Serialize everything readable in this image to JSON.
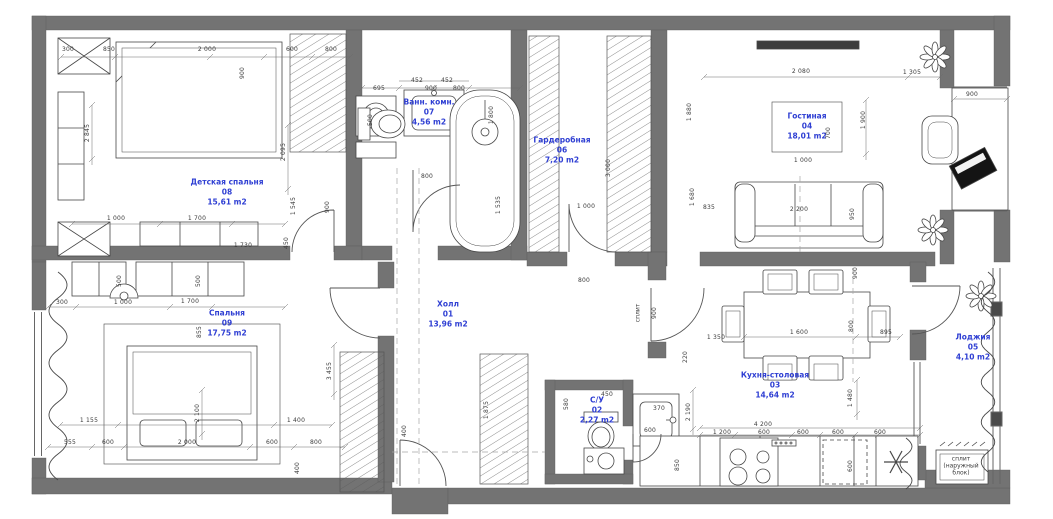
{
  "colors": {
    "wall": "#737373",
    "room_label_blue": "#2f3fd3",
    "dim_text": "#3c3c3c",
    "furniture_line": "#474747",
    "background": "#ffffff"
  },
  "rooms": [
    {
      "name": "Детская спальня",
      "number": "08",
      "area": "15,61 m2",
      "x": 227,
      "y": 192
    },
    {
      "name": "Ванн. комн.",
      "number": "07",
      "area": "4,56 m2",
      "x": 429,
      "y": 112
    },
    {
      "name": "Гардеробная",
      "number": "06",
      "area": "7,20 m2",
      "x": 562,
      "y": 150
    },
    {
      "name": "Гостиная",
      "number": "04",
      "area": "18,01 m2",
      "x": 807,
      "y": 126
    },
    {
      "name": "Спальня",
      "number": "09",
      "area": "17,75 m2",
      "x": 227,
      "y": 323
    },
    {
      "name": "Холл",
      "number": "01",
      "area": "13,96 m2",
      "x": 448,
      "y": 314
    },
    {
      "name": "С/У",
      "number": "02",
      "area": "2,27 m2",
      "x": 597,
      "y": 410
    },
    {
      "name": "Кухня-столовая",
      "number": "03",
      "area": "14,64 m2",
      "x": 775,
      "y": 385
    },
    {
      "name": "Лоджия",
      "number": "05",
      "area": "4,10 m2",
      "x": 973,
      "y": 347
    }
  ],
  "annotations": [
    {
      "text": "сплит",
      "x": 639,
      "y": 313,
      "rot": true,
      "lines": [
        "сплит"
      ]
    },
    {
      "text": "сплит (наружный блок)",
      "x": 961,
      "y": 467,
      "rot": false,
      "lines": [
        "сплит",
        "(наружный",
        "блок)"
      ]
    }
  ],
  "dimensions": [
    {
      "t": "300",
      "x": 68,
      "y": 50
    },
    {
      "t": "850",
      "x": 109,
      "y": 50
    },
    {
      "t": "2 000",
      "x": 207,
      "y": 50
    },
    {
      "t": "600",
      "x": 292,
      "y": 50
    },
    {
      "t": "800",
      "x": 331,
      "y": 50
    },
    {
      "t": "900",
      "x": 243,
      "y": 73,
      "r": 1
    },
    {
      "t": "2 845",
      "x": 88,
      "y": 133,
      "r": 1
    },
    {
      "t": "2 095",
      "x": 284,
      "y": 152,
      "r": 1
    },
    {
      "t": "1 545",
      "x": 294,
      "y": 206,
      "r": 1
    },
    {
      "t": "900",
      "x": 328,
      "y": 207,
      "r": 1
    },
    {
      "t": "450",
      "x": 287,
      "y": 243,
      "r": 1
    },
    {
      "t": "1 000",
      "x": 116,
      "y": 219
    },
    {
      "t": "1 700",
      "x": 197,
      "y": 219
    },
    {
      "t": "1 730",
      "x": 243,
      "y": 246
    },
    {
      "t": "695",
      "x": 379,
      "y": 89
    },
    {
      "t": "452",
      "x": 417,
      "y": 81
    },
    {
      "t": "452",
      "x": 447,
      "y": 81
    },
    {
      "t": "900",
      "x": 431,
      "y": 89
    },
    {
      "t": "800",
      "x": 459,
      "y": 89
    },
    {
      "t": "500",
      "x": 371,
      "y": 120,
      "r": 1
    },
    {
      "t": "1 800",
      "x": 492,
      "y": 115,
      "r": 1
    },
    {
      "t": "800",
      "x": 427,
      "y": 177
    },
    {
      "t": "1 535",
      "x": 499,
      "y": 205,
      "r": 1
    },
    {
      "t": "3 000",
      "x": 609,
      "y": 168,
      "r": 1
    },
    {
      "t": "1 000",
      "x": 586,
      "y": 207
    },
    {
      "t": "800",
      "x": 584,
      "y": 281
    },
    {
      "t": "2 080",
      "x": 801,
      "y": 72
    },
    {
      "t": "1 305",
      "x": 912,
      "y": 73
    },
    {
      "t": "900",
      "x": 972,
      "y": 95
    },
    {
      "t": "1 900",
      "x": 864,
      "y": 120,
      "r": 1
    },
    {
      "t": "700",
      "x": 829,
      "y": 133,
      "r": 1
    },
    {
      "t": "1 000",
      "x": 803,
      "y": 161
    },
    {
      "t": "1 880",
      "x": 690,
      "y": 112,
      "r": 1
    },
    {
      "t": "1 680",
      "x": 693,
      "y": 197,
      "r": 1
    },
    {
      "t": "835",
      "x": 709,
      "y": 208
    },
    {
      "t": "2 200",
      "x": 799,
      "y": 210
    },
    {
      "t": "950",
      "x": 853,
      "y": 214,
      "r": 1
    },
    {
      "t": "900",
      "x": 655,
      "y": 313,
      "r": 1
    },
    {
      "t": "220",
      "x": 686,
      "y": 357,
      "r": 1
    },
    {
      "t": "900",
      "x": 856,
      "y": 273,
      "r": 1
    },
    {
      "t": "1 600",
      "x": 799,
      "y": 333
    },
    {
      "t": "800",
      "x": 852,
      "y": 326,
      "r": 1
    },
    {
      "t": "895",
      "x": 886,
      "y": 333
    },
    {
      "t": "1 350",
      "x": 716,
      "y": 338
    },
    {
      "t": "1 480",
      "x": 851,
      "y": 398,
      "r": 1
    },
    {
      "t": "2 190",
      "x": 689,
      "y": 412,
      "r": 1
    },
    {
      "t": "450",
      "x": 607,
      "y": 395
    },
    {
      "t": "370",
      "x": 659,
      "y": 409
    },
    {
      "t": "580",
      "x": 567,
      "y": 404,
      "r": 1
    },
    {
      "t": "4 200",
      "x": 763,
      "y": 425
    },
    {
      "t": "1 200",
      "x": 722,
      "y": 433
    },
    {
      "t": "600",
      "x": 764,
      "y": 433
    },
    {
      "t": "600",
      "x": 803,
      "y": 433
    },
    {
      "t": "600",
      "x": 838,
      "y": 433
    },
    {
      "t": "600",
      "x": 880,
      "y": 433
    },
    {
      "t": "850",
      "x": 678,
      "y": 465,
      "r": 1
    },
    {
      "t": "600",
      "x": 851,
      "y": 466,
      "r": 1
    },
    {
      "t": "600",
      "x": 650,
      "y": 431
    },
    {
      "t": "1 875",
      "x": 487,
      "y": 410,
      "r": 1
    },
    {
      "t": "400",
      "x": 405,
      "y": 431,
      "r": 1
    },
    {
      "t": "500",
      "x": 120,
      "y": 281,
      "r": 1
    },
    {
      "t": "500",
      "x": 199,
      "y": 281,
      "r": 1
    },
    {
      "t": "300",
      "x": 62,
      "y": 303
    },
    {
      "t": "1 000",
      "x": 123,
      "y": 303
    },
    {
      "t": "1 700",
      "x": 190,
      "y": 302
    },
    {
      "t": "855",
      "x": 200,
      "y": 332,
      "r": 1
    },
    {
      "t": "2 100",
      "x": 198,
      "y": 413,
      "r": 1
    },
    {
      "t": "1 155",
      "x": 89,
      "y": 421
    },
    {
      "t": "1 400",
      "x": 296,
      "y": 421
    },
    {
      "t": "555",
      "x": 70,
      "y": 443
    },
    {
      "t": "600",
      "x": 108,
      "y": 443
    },
    {
      "t": "2 000",
      "x": 187,
      "y": 443
    },
    {
      "t": "600",
      "x": 272,
      "y": 443
    },
    {
      "t": "800",
      "x": 316,
      "y": 443
    },
    {
      "t": "3 455",
      "x": 330,
      "y": 371,
      "r": 1
    },
    {
      "t": "400",
      "x": 298,
      "y": 468,
      "r": 1
    }
  ]
}
